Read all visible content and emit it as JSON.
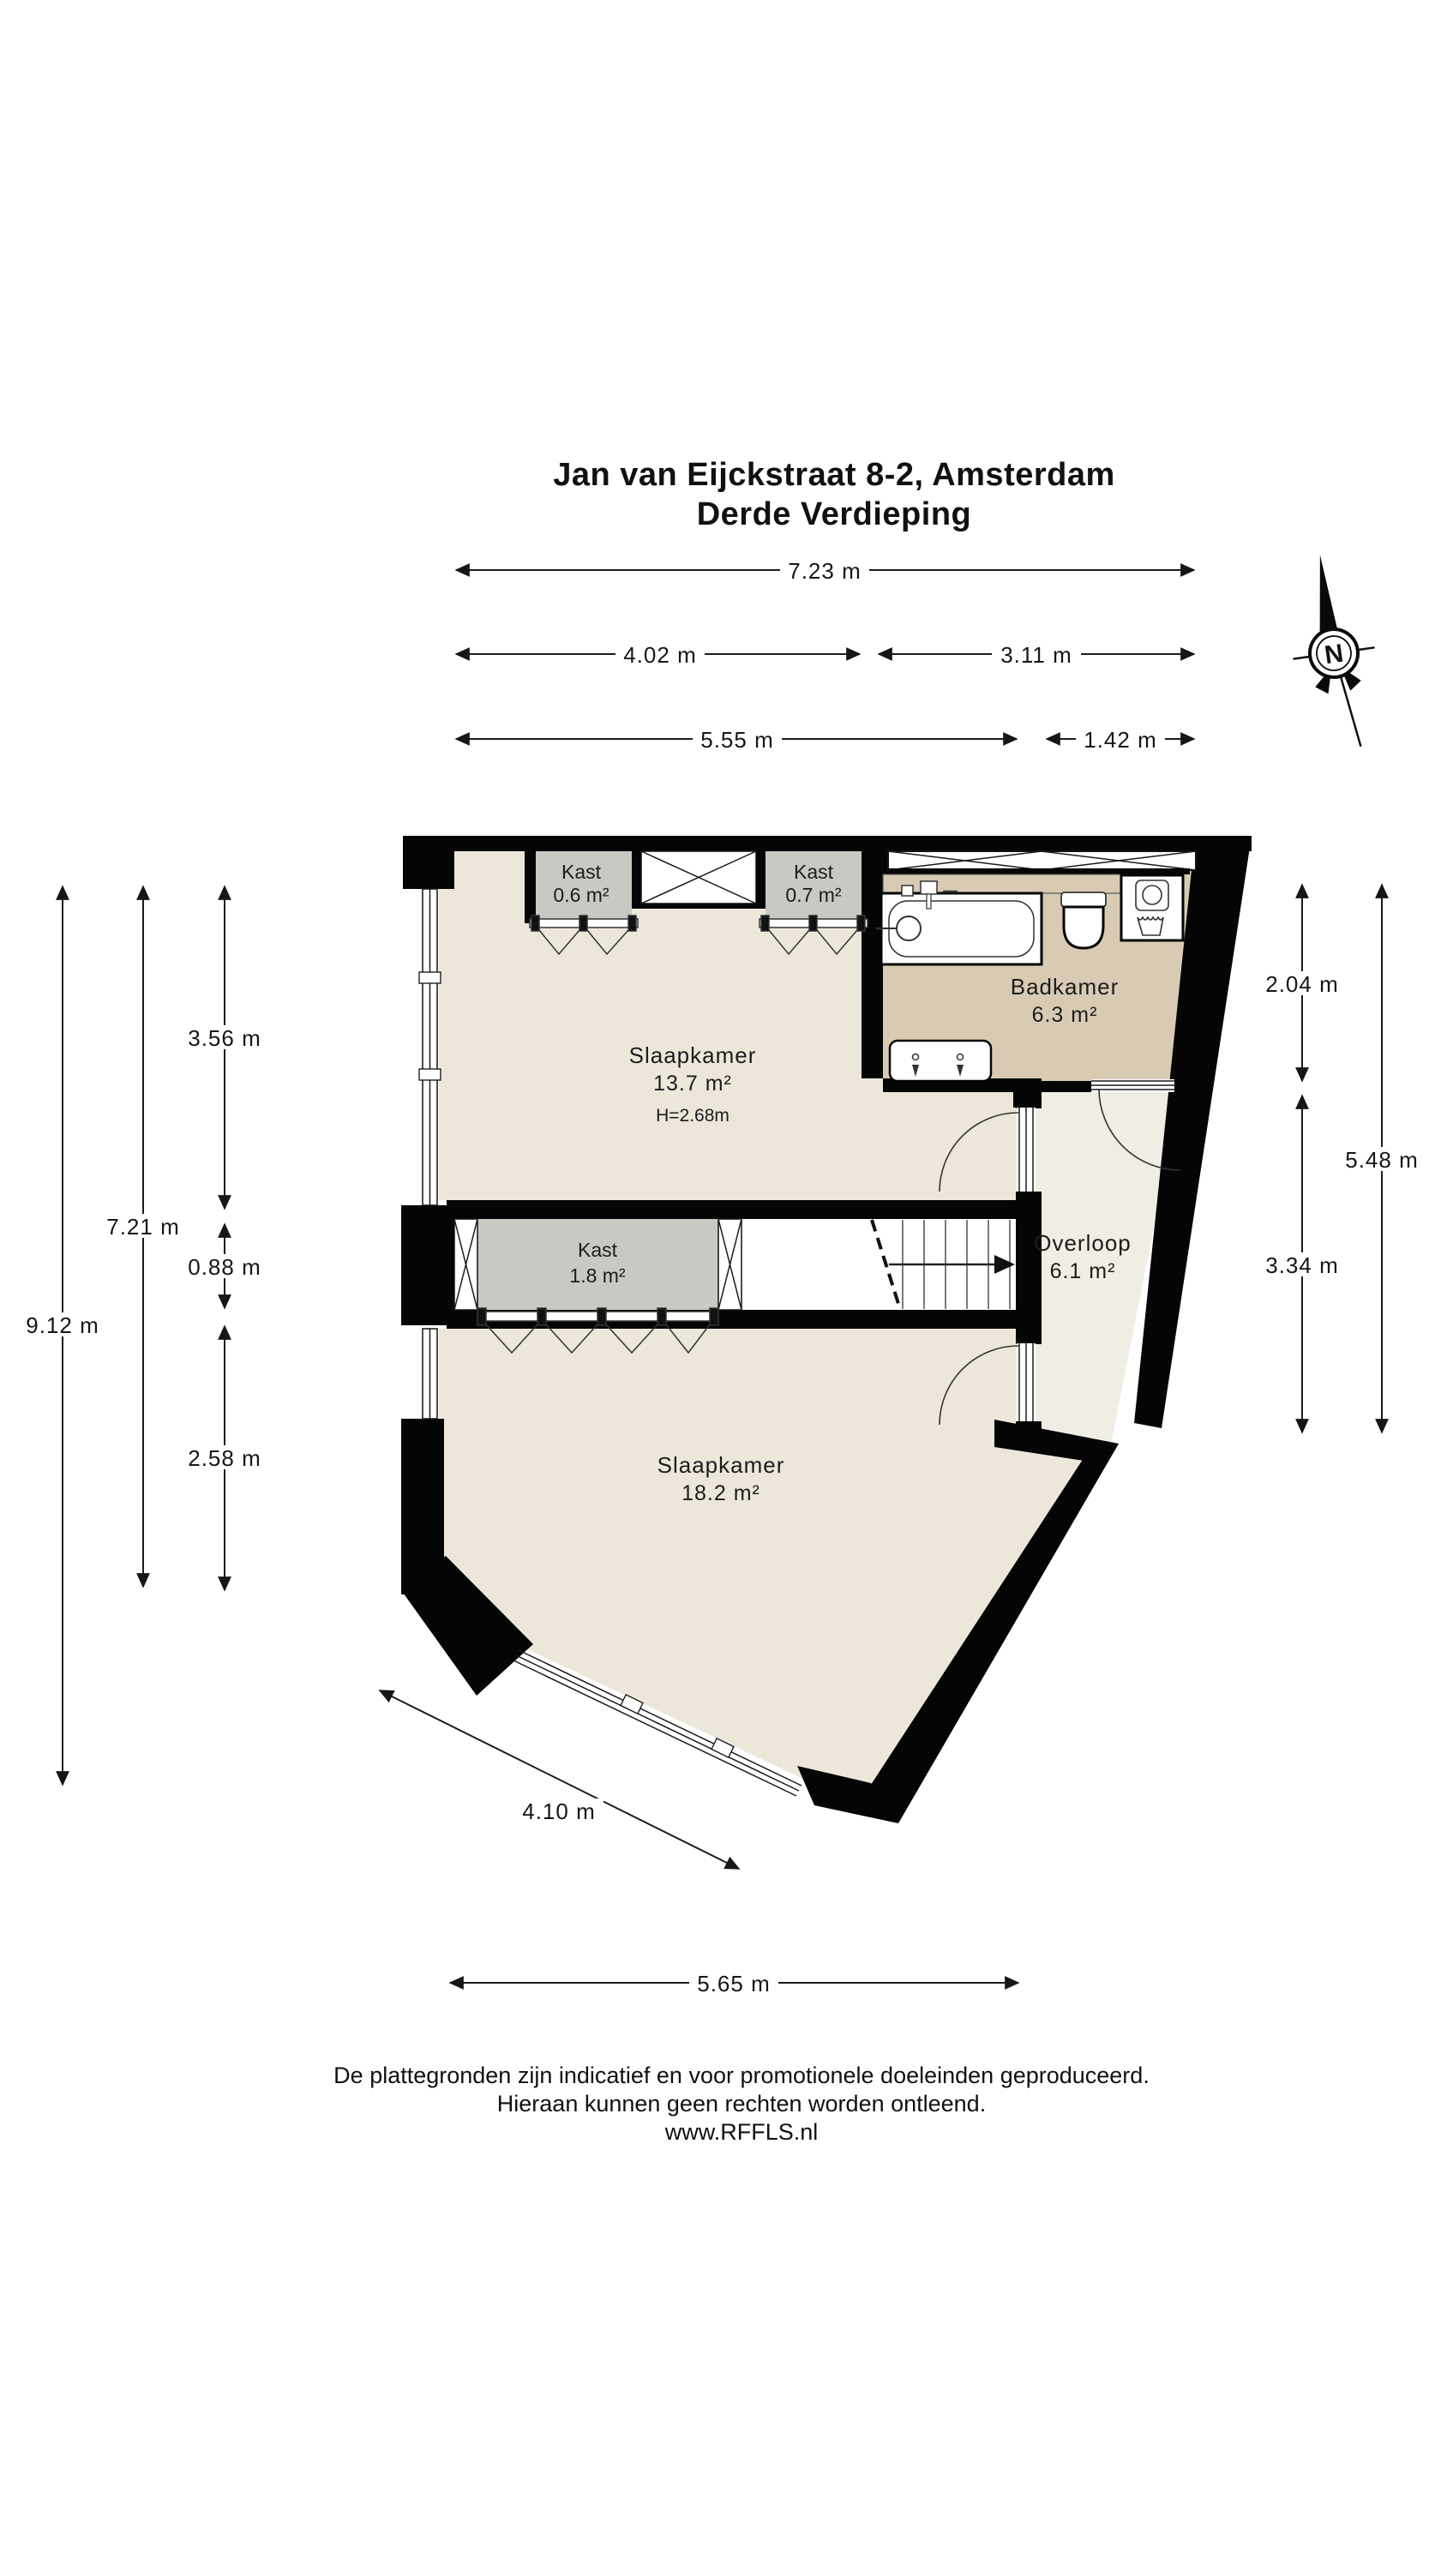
{
  "title": {
    "line1": "Jan van Eijckstraat 8-2, Amsterdam",
    "line2": "Derde Verdieping"
  },
  "compass": {
    "north_label": "N"
  },
  "rooms": {
    "slaapkamer1": {
      "name": "Slaapkamer",
      "area": "13.7 m²",
      "height": "H=2.68m"
    },
    "slaapkamer2": {
      "name": "Slaapkamer",
      "area": "18.2 m²"
    },
    "badkamer": {
      "name": "Badkamer",
      "area": "6.3 m²"
    },
    "overloop": {
      "name": "Overloop",
      "area": "6.1 m²"
    },
    "kast1": {
      "name": "Kast",
      "area": "0.6 m²"
    },
    "kast2": {
      "name": "Kast",
      "area": "0.7 m²"
    },
    "kast3": {
      "name": "Kast",
      "area": "1.8 m²"
    }
  },
  "dimensions": {
    "top": [
      {
        "label": "7.23 m"
      },
      {
        "label": "4.02 m"
      },
      {
        "label": "3.11 m"
      },
      {
        "label": "5.55 m"
      },
      {
        "label": "1.42 m"
      }
    ],
    "left": [
      {
        "label": "9.12 m"
      },
      {
        "label": "7.21 m"
      },
      {
        "label": "3.56 m"
      },
      {
        "label": "0.88 m"
      },
      {
        "label": "2.58 m"
      }
    ],
    "right": [
      {
        "label": "2.04 m"
      },
      {
        "label": "3.34 m"
      },
      {
        "label": "5.48 m"
      }
    ],
    "bottom": [
      {
        "label": "4.10 m"
      },
      {
        "label": "5.65 m"
      }
    ]
  },
  "fixtures": [
    "bathtub",
    "toilet",
    "washing-machine",
    "laundry-basin",
    "double-sink-vanity",
    "stairs-up"
  ],
  "colors": {
    "wall": "#050505",
    "floor_bedroom": "#ece7d9",
    "floor_landing": "#f0ede4",
    "floor_bathroom": "#d8cab3",
    "closet_gray": "#c7c9c2"
  },
  "footer": {
    "line1": "De plattegronden zijn indicatief en voor promotionele doeleinden geproduceerd.",
    "line2": "Hieraan kunnen geen rechten worden ontleend.",
    "line3": "www.RFFLS.nl"
  }
}
